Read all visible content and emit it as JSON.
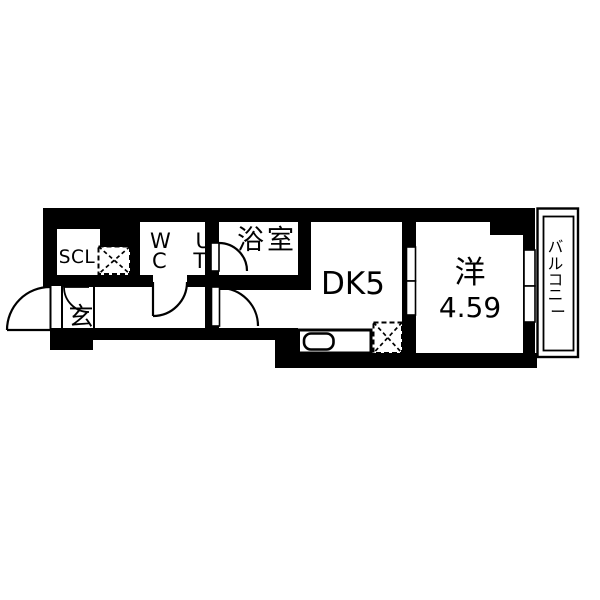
{
  "floorplan": {
    "rooms": {
      "scl": {
        "label": "SCL"
      },
      "wc_ut": {
        "row1": "W U",
        "row2": "C T"
      },
      "bathroom": {
        "label": "浴室"
      },
      "entrance": {
        "label": "玄"
      },
      "dining_kitchen": {
        "label": "DK5"
      },
      "western_room": {
        "label": "洋",
        "size": "4.59"
      },
      "balcony": {
        "label": "バルコニー",
        "chars": [
          "バ",
          "ル",
          "コ",
          "ニ",
          "ー"
        ]
      }
    },
    "fixtures": {
      "kitchen_sink": "sink-counter",
      "storage_cross_boxes": 2
    },
    "colors": {
      "wall": "#000000",
      "background": "#ffffff"
    }
  }
}
